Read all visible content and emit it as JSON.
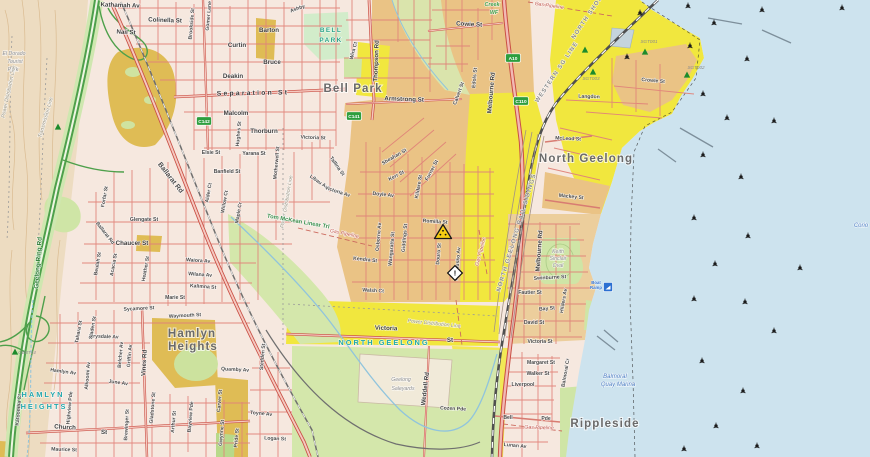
{
  "map": {
    "colors": {
      "water": "#cde3ee",
      "urban_base": "#f6e8df",
      "industrial_orange": "#eac385",
      "coastal_tan": "#ecce9c",
      "easement_yellow": "#f1e73e",
      "mustard": "#dfbc55",
      "park_green": "#cfe5a6",
      "road_red": "#e08379",
      "road_casing": "#c94f44",
      "freeway_green": "#4ea04b",
      "rail_gray": "#4f4f4f",
      "shield_green": "#2e9e3e",
      "locality_teal": "#23a7ad",
      "contour_tan": "#d8b88c"
    },
    "labels": [
      {
        "t": "El Dorado",
        "x": 14,
        "y": 55,
        "r": 0,
        "c": "infra"
      },
      {
        "t": "Tourist",
        "x": 15,
        "y": 63,
        "r": 0,
        "c": "infra"
      },
      {
        "t": "Park",
        "x": 13,
        "y": 71,
        "r": 0,
        "c": "infra"
      },
      {
        "t": "Power Distribution Line",
        "x": 10,
        "y": 92,
        "r": -78,
        "c": "pwr"
      },
      {
        "t": "Transmission Line",
        "x": 47,
        "y": 118,
        "r": -74,
        "c": "pwr"
      },
      {
        "t": "Geelong Ring Rd",
        "x": 40,
        "y": 263,
        "r": -86,
        "c": "ring"
      },
      {
        "t": "Kathamah Av",
        "x": 120,
        "y": 7,
        "r": 2,
        "c": "st"
      },
      {
        "t": "Colinella St",
        "x": 165,
        "y": 22,
        "r": 2,
        "c": "st"
      },
      {
        "t": "Nail St",
        "x": 126,
        "y": 34,
        "r": 3,
        "c": "st"
      },
      {
        "t": "Gomer Lane",
        "x": 210,
        "y": 16,
        "r": -85,
        "c": "sv"
      },
      {
        "t": "Brookside St",
        "x": 193,
        "y": 24,
        "r": -85,
        "c": "sv"
      },
      {
        "t": "Ashby",
        "x": 298,
        "y": 10,
        "r": -20,
        "c": "sv"
      },
      {
        "t": "Barton",
        "x": 269,
        "y": 32,
        "r": 0,
        "c": "st"
      },
      {
        "t": "Curtin",
        "x": 237,
        "y": 47,
        "r": 0,
        "c": "st"
      },
      {
        "t": "Bruce",
        "x": 272,
        "y": 64,
        "r": 0,
        "c": "st"
      },
      {
        "t": "Deakin",
        "x": 233,
        "y": 78,
        "r": 0,
        "c": "st"
      },
      {
        "t": "Separation St",
        "x": 253,
        "y": 95,
        "r": -1,
        "c": "stw"
      },
      {
        "t": "Malcolm",
        "x": 236,
        "y": 115,
        "r": 0,
        "c": "st"
      },
      {
        "t": "Thorburn",
        "x": 264,
        "y": 133,
        "r": 0,
        "c": "st"
      },
      {
        "t": "Hughes St",
        "x": 240,
        "y": 134,
        "r": -85,
        "c": "sv"
      },
      {
        "t": "Elsie St",
        "x": 211,
        "y": 154,
        "r": 0,
        "c": "sv"
      },
      {
        "t": "Yarana St",
        "x": 254,
        "y": 155,
        "r": 0,
        "c": "sv"
      },
      {
        "t": "Banfield St",
        "x": 227,
        "y": 173,
        "r": 0,
        "c": "sv"
      },
      {
        "t": "Alder Ct",
        "x": 210,
        "y": 193,
        "r": -80,
        "c": "sv"
      },
      {
        "t": "Willow Ct",
        "x": 226,
        "y": 202,
        "r": -80,
        "c": "sv"
      },
      {
        "t": "Maple Cr",
        "x": 240,
        "y": 213,
        "r": -80,
        "c": "sv"
      },
      {
        "t": "Motherwell St",
        "x": 278,
        "y": 163,
        "r": -85,
        "c": "sv"
      },
      {
        "t": "Power Distribution Line",
        "x": 288,
        "y": 202,
        "r": -80,
        "c": "pwr"
      },
      {
        "t": "Libau Av",
        "x": 318,
        "y": 183,
        "r": 35,
        "c": "sv"
      },
      {
        "t": "Tallina St",
        "x": 336,
        "y": 167,
        "r": 55,
        "c": "sv"
      },
      {
        "t": "Victoria Av",
        "x": 337,
        "y": 193,
        "r": 18,
        "c": "sv"
      },
      {
        "t": "Victoria St",
        "x": 313,
        "y": 139,
        "r": 2,
        "c": "sv"
      },
      {
        "t": "Tom McKean Linear Trl",
        "x": 298,
        "y": 223,
        "r": 10,
        "c": "trail"
      },
      {
        "t": "Gas Pipeline",
        "x": 344,
        "y": 235,
        "r": 12,
        "c": "gas"
      },
      {
        "t": "Ballarat Rd",
        "x": 169,
        "y": 179,
        "r": 52,
        "c": "rd"
      },
      {
        "t": "Ballarat Rd",
        "x": 104,
        "y": 234,
        "r": 52,
        "c": "sv"
      },
      {
        "t": "Forfar St",
        "x": 106,
        "y": 197,
        "r": -80,
        "c": "sv"
      },
      {
        "t": "Glengate St",
        "x": 144,
        "y": 221,
        "r": 0,
        "c": "sv"
      },
      {
        "t": "Chaucer St",
        "x": 132,
        "y": 245,
        "r": 0,
        "c": "st"
      },
      {
        "t": "Beulah St",
        "x": 99,
        "y": 264,
        "r": -80,
        "c": "sv"
      },
      {
        "t": "Acacia St",
        "x": 115,
        "y": 265,
        "r": -80,
        "c": "sv"
      },
      {
        "t": "Heather St",
        "x": 147,
        "y": 269,
        "r": -80,
        "c": "sv"
      },
      {
        "t": "Waiora Av",
        "x": 198,
        "y": 262,
        "r": 4,
        "c": "sv"
      },
      {
        "t": "Wilana Av",
        "x": 200,
        "y": 276,
        "r": 4,
        "c": "sv"
      },
      {
        "t": "Kalimna St",
        "x": 203,
        "y": 288,
        "r": 4,
        "c": "sv"
      },
      {
        "t": "Marie St",
        "x": 175,
        "y": 299,
        "r": 0,
        "c": "sv"
      },
      {
        "t": "Sycamore St",
        "x": 139,
        "y": 310,
        "r": -3,
        "c": "sv"
      },
      {
        "t": "Waymouth St",
        "x": 185,
        "y": 317,
        "r": -3,
        "c": "sv"
      },
      {
        "t": "Drysdale Av",
        "x": 104,
        "y": 338,
        "r": 2,
        "c": "sv"
      },
      {
        "t": "Tahara St",
        "x": 80,
        "y": 332,
        "r": -80,
        "c": "sv"
      },
      {
        "t": "Sladen St",
        "x": 94,
        "y": 328,
        "r": -80,
        "c": "sv"
      },
      {
        "t": "Hamlyn Av",
        "x": 63,
        "y": 373,
        "r": 8,
        "c": "sv"
      },
      {
        "t": "June Av",
        "x": 118,
        "y": 384,
        "r": 8,
        "c": "sv"
      },
      {
        "t": "Vines Rd",
        "x": 146,
        "y": 363,
        "r": -87,
        "c": "st"
      },
      {
        "t": "Belcher Av",
        "x": 122,
        "y": 355,
        "r": -85,
        "c": "sv"
      },
      {
        "t": "Griffin Av",
        "x": 131,
        "y": 356,
        "r": -85,
        "c": "sv"
      },
      {
        "t": "Alkoomi Av",
        "x": 89,
        "y": 376,
        "r": -85,
        "c": "sv"
      },
      {
        "t": "Highview Pde",
        "x": 71,
        "y": 408,
        "r": -85,
        "c": "sv"
      },
      {
        "t": "Katoomba Ct",
        "x": 20,
        "y": 410,
        "r": -85,
        "c": "sv"
      },
      {
        "t": "HAMLYN",
        "x": 43,
        "y": 397,
        "r": 0,
        "c": "loc"
      },
      {
        "t": "HEIGHTS",
        "x": 44,
        "y": 409,
        "r": 0,
        "c": "loc"
      },
      {
        "t": "Hamlyn",
        "x": 192,
        "y": 337,
        "r": 0,
        "c": "sub"
      },
      {
        "t": "Heights",
        "x": 193,
        "y": 350,
        "r": 0,
        "c": "sub"
      },
      {
        "t": "Church",
        "x": 65,
        "y": 429,
        "r": 3,
        "c": "st"
      },
      {
        "t": "St",
        "x": 104,
        "y": 434,
        "r": 3,
        "c": "st"
      },
      {
        "t": "Maurice St",
        "x": 64,
        "y": 451,
        "r": 2,
        "c": "sv"
      },
      {
        "t": "Gladstone St",
        "x": 154,
        "y": 408,
        "r": -85,
        "c": "sv"
      },
      {
        "t": "Brewinger St",
        "x": 128,
        "y": 425,
        "r": -87,
        "c": "sv"
      },
      {
        "t": "Arthur St",
        "x": 175,
        "y": 422,
        "r": -85,
        "c": "sv"
      },
      {
        "t": "Bayview Pde",
        "x": 192,
        "y": 417,
        "r": -85,
        "c": "sv"
      },
      {
        "t": "Carver St",
        "x": 221,
        "y": 401,
        "r": -85,
        "c": "sv"
      },
      {
        "t": "Gwynne St",
        "x": 223,
        "y": 433,
        "r": -85,
        "c": "sv"
      },
      {
        "t": "Pride St",
        "x": 238,
        "y": 438,
        "r": -85,
        "c": "sv"
      },
      {
        "t": "Quamby Av",
        "x": 235,
        "y": 371,
        "r": 3,
        "c": "sv"
      },
      {
        "t": "Stedden St",
        "x": 264,
        "y": 357,
        "r": -85,
        "c": "sv"
      },
      {
        "t": "Toyne Av",
        "x": 261,
        "y": 415,
        "r": 5,
        "c": "sv"
      },
      {
        "t": "Logan St",
        "x": 275,
        "y": 440,
        "r": 3,
        "c": "sv"
      },
      {
        "t": "NORTH GEELONG",
        "x": 384,
        "y": 345,
        "r": 0,
        "c": "loc"
      },
      {
        "t": "Victoria",
        "x": 386,
        "y": 330,
        "r": 2,
        "c": "st"
      },
      {
        "t": "St",
        "x": 450,
        "y": 342,
        "r": 0,
        "c": "st"
      },
      {
        "t": "Power Distribution Line",
        "x": 434,
        "y": 325,
        "r": 6,
        "c": "pwr"
      },
      {
        "t": "Geelong",
        "x": 401,
        "y": 381,
        "r": 0,
        "c": "infra"
      },
      {
        "t": "Saleyards",
        "x": 403,
        "y": 390,
        "r": 0,
        "c": "infra"
      },
      {
        "t": "Weddell Rd",
        "x": 427,
        "y": 389,
        "r": -83,
        "c": "st"
      },
      {
        "t": "Cozen Pde",
        "x": 453,
        "y": 410,
        "r": 3,
        "c": "sv"
      },
      {
        "t": "Lunan Av",
        "x": 515,
        "y": 447,
        "r": 5,
        "c": "sv"
      },
      {
        "t": "Gas Pipeline",
        "x": 539,
        "y": 429,
        "r": 2,
        "c": "gas"
      },
      {
        "t": "Bell",
        "x": 508,
        "y": 419,
        "r": 0,
        "c": "sv"
      },
      {
        "t": "Pde",
        "x": 546,
        "y": 420,
        "r": 0,
        "c": "sv"
      },
      {
        "t": "Liverpool",
        "x": 523,
        "y": 386,
        "r": 0,
        "c": "sv"
      },
      {
        "t": "Walker St",
        "x": 538,
        "y": 375,
        "r": 0,
        "c": "sv"
      },
      {
        "t": "Margaret St",
        "x": 541,
        "y": 364,
        "r": 0,
        "c": "sv"
      },
      {
        "t": "Victoria St",
        "x": 540,
        "y": 343,
        "r": 0,
        "c": "sv"
      },
      {
        "t": "David St",
        "x": 534,
        "y": 324,
        "r": 0,
        "c": "sv"
      },
      {
        "t": "Bay St",
        "x": 547,
        "y": 310,
        "r": -5,
        "c": "sv"
      },
      {
        "t": "Fautier St",
        "x": 530,
        "y": 294,
        "r": 0,
        "c": "sv"
      },
      {
        "t": "Swinburne St",
        "x": 550,
        "y": 279,
        "r": -3,
        "c": "sv"
      },
      {
        "t": "Hilders Av",
        "x": 565,
        "y": 301,
        "r": -80,
        "c": "sv"
      },
      {
        "t": "Balmoral Cr",
        "x": 567,
        "y": 373,
        "r": -80,
        "c": "sv"
      },
      {
        "t": "Keith",
        "x": 558,
        "y": 253,
        "r": 0,
        "c": "infra"
      },
      {
        "t": "Sinclair",
        "x": 558,
        "y": 260,
        "r": 0,
        "c": "infra"
      },
      {
        "t": "Oval",
        "x": 558,
        "y": 267,
        "r": 0,
        "c": "infra"
      },
      {
        "t": "Rippleside",
        "x": 605,
        "y": 427,
        "r": 0,
        "c": "sub"
      },
      {
        "t": "Balmoral",
        "x": 615,
        "y": 378,
        "r": 0,
        "c": "water"
      },
      {
        "t": "Quay Marina",
        "x": 618,
        "y": 386,
        "r": 0,
        "c": "water"
      },
      {
        "t": "Boat",
        "x": 596,
        "y": 284,
        "r": 0,
        "c": "tinyb"
      },
      {
        "t": "Ramp",
        "x": 596,
        "y": 289,
        "r": 0,
        "c": "tinyb"
      },
      {
        "t": "Corio",
        "x": 861,
        "y": 227,
        "r": 0,
        "c": "water"
      },
      {
        "t": "Sheahan St",
        "x": 395,
        "y": 158,
        "r": -30,
        "c": "sv"
      },
      {
        "t": "Kerr St",
        "x": 397,
        "y": 177,
        "r": -28,
        "c": "sv"
      },
      {
        "t": "Furner St",
        "x": 433,
        "y": 171,
        "r": -62,
        "c": "sv"
      },
      {
        "t": "Kildare St",
        "x": 420,
        "y": 187,
        "r": -80,
        "c": "sv"
      },
      {
        "t": "Doyle Av",
        "x": 383,
        "y": 196,
        "r": 6,
        "c": "sv"
      },
      {
        "t": "Osborne Av",
        "x": 380,
        "y": 237,
        "r": -85,
        "c": "sv"
      },
      {
        "t": "Wangaratta St",
        "x": 393,
        "y": 249,
        "r": -85,
        "c": "sv"
      },
      {
        "t": "Giddings St",
        "x": 406,
        "y": 238,
        "r": -85,
        "c": "sv"
      },
      {
        "t": "Romilla St",
        "x": 435,
        "y": 223,
        "r": 4,
        "c": "sv"
      },
      {
        "t": "Douro St",
        "x": 440,
        "y": 254,
        "r": -85,
        "c": "sv"
      },
      {
        "t": "Kosciusko Av",
        "x": 459,
        "y": 264,
        "r": -85,
        "c": "sv"
      },
      {
        "t": "Gas Pipeline",
        "x": 482,
        "y": 252,
        "r": -75,
        "c": "gas"
      },
      {
        "t": "Kendra St",
        "x": 365,
        "y": 261,
        "r": 6,
        "c": "sv"
      },
      {
        "t": "Walsh Ct",
        "x": 373,
        "y": 292,
        "r": 3,
        "c": "sv"
      },
      {
        "t": "NORTH GEELONG RAIL SIDINGS",
        "x": 518,
        "y": 233,
        "r": -73,
        "c": "rail"
      },
      {
        "t": "Melbourne Rd",
        "x": 541,
        "y": 251,
        "r": -86,
        "c": "st"
      },
      {
        "t": "Melbourne Rd",
        "x": 493,
        "y": 93,
        "r": -85,
        "c": "st"
      },
      {
        "t": "WESTERN SG LINE",
        "x": 558,
        "y": 73,
        "r": -56,
        "c": "rail"
      },
      {
        "t": "NORTH SHORE",
        "x": 590,
        "y": 16,
        "r": -56,
        "c": "rail"
      },
      {
        "t": "Bell Park",
        "x": 353,
        "y": 92,
        "r": 0,
        "c": "sub"
      },
      {
        "t": "Armstrong St",
        "x": 404,
        "y": 101,
        "r": 2,
        "c": "st"
      },
      {
        "t": "BELL",
        "x": 331,
        "y": 32,
        "r": 0,
        "c": "loc2"
      },
      {
        "t": "PARK",
        "x": 331,
        "y": 42,
        "r": 0,
        "c": "loc2"
      },
      {
        "t": "Thompson Rd",
        "x": 378,
        "y": 61,
        "r": -88,
        "c": "st"
      },
      {
        "t": "Wira Ct",
        "x": 355,
        "y": 51,
        "r": -75,
        "c": "sv"
      },
      {
        "t": "Cowie St",
        "x": 469,
        "y": 26,
        "r": 3,
        "c": "st"
      },
      {
        "t": "Edols St",
        "x": 476,
        "y": 78,
        "r": -85,
        "c": "sv"
      },
      {
        "t": "Calvert St",
        "x": 460,
        "y": 94,
        "r": -70,
        "c": "sv"
      },
      {
        "t": "Creek",
        "x": 492,
        "y": 6,
        "r": 0,
        "c": "park"
      },
      {
        "t": "WF",
        "x": 494,
        "y": 14,
        "r": 0,
        "c": "park"
      },
      {
        "t": "Gas Pipeline",
        "x": 549,
        "y": 7,
        "r": 8,
        "c": "gas"
      },
      {
        "t": "McLeod St",
        "x": 568,
        "y": 140,
        "r": 3,
        "c": "sv"
      },
      {
        "t": "North Geelong",
        "x": 586,
        "y": 162,
        "r": 0,
        "c": "sub"
      },
      {
        "t": "Mackey St",
        "x": 571,
        "y": 198,
        "r": 6,
        "c": "sv"
      },
      {
        "t": "Crowle St",
        "x": 653,
        "y": 82,
        "r": 5,
        "c": "sv"
      },
      {
        "t": "Langdon",
        "x": 589,
        "y": 98,
        "r": 2,
        "c": "sv"
      },
      {
        "t": "SGT001",
        "x": 649,
        "y": 43,
        "r": 0,
        "c": "tiny"
      },
      {
        "t": "SGT002",
        "x": 696,
        "y": 69,
        "r": 0,
        "c": "tiny"
      },
      {
        "t": "SGT003",
        "x": 591,
        "y": 80,
        "r": 0,
        "c": "tiny"
      },
      {
        "t": "GBBT14",
        "x": 27,
        "y": 354,
        "r": 0,
        "c": "tiny"
      }
    ],
    "route_shields": [
      {
        "t": "A10",
        "x": 513,
        "y": 58
      },
      {
        "t": "C110",
        "x": 521,
        "y": 101
      },
      {
        "t": "C141",
        "x": 354,
        "y": 116
      },
      {
        "t": "C142",
        "x": 204,
        "y": 121
      }
    ],
    "survey_triangles": [
      [
        585,
        50
      ],
      [
        645,
        52
      ],
      [
        687,
        75
      ],
      [
        593,
        72
      ],
      [
        58,
        127
      ],
      [
        15,
        352
      ]
    ],
    "water_markers": [
      [
        640,
        13
      ],
      [
        688,
        6
      ],
      [
        714,
        23
      ],
      [
        762,
        10
      ],
      [
        842,
        8
      ],
      [
        627,
        57
      ],
      [
        690,
        46
      ],
      [
        747,
        59
      ],
      [
        703,
        94
      ],
      [
        727,
        118
      ],
      [
        774,
        121
      ],
      [
        703,
        155
      ],
      [
        741,
        177
      ],
      [
        694,
        218
      ],
      [
        748,
        236
      ],
      [
        800,
        268
      ],
      [
        715,
        264
      ],
      [
        694,
        299
      ],
      [
        745,
        302
      ],
      [
        774,
        331
      ],
      [
        702,
        361
      ],
      [
        743,
        391
      ],
      [
        716,
        426
      ],
      [
        684,
        449
      ],
      [
        757,
        446
      ]
    ],
    "icons": {
      "hazard": {
        "x": 443,
        "y": 232
      },
      "incident": {
        "x": 455,
        "y": 273,
        "glyph": "!"
      },
      "boat_ramp": {
        "x": 608,
        "y": 287
      }
    }
  }
}
